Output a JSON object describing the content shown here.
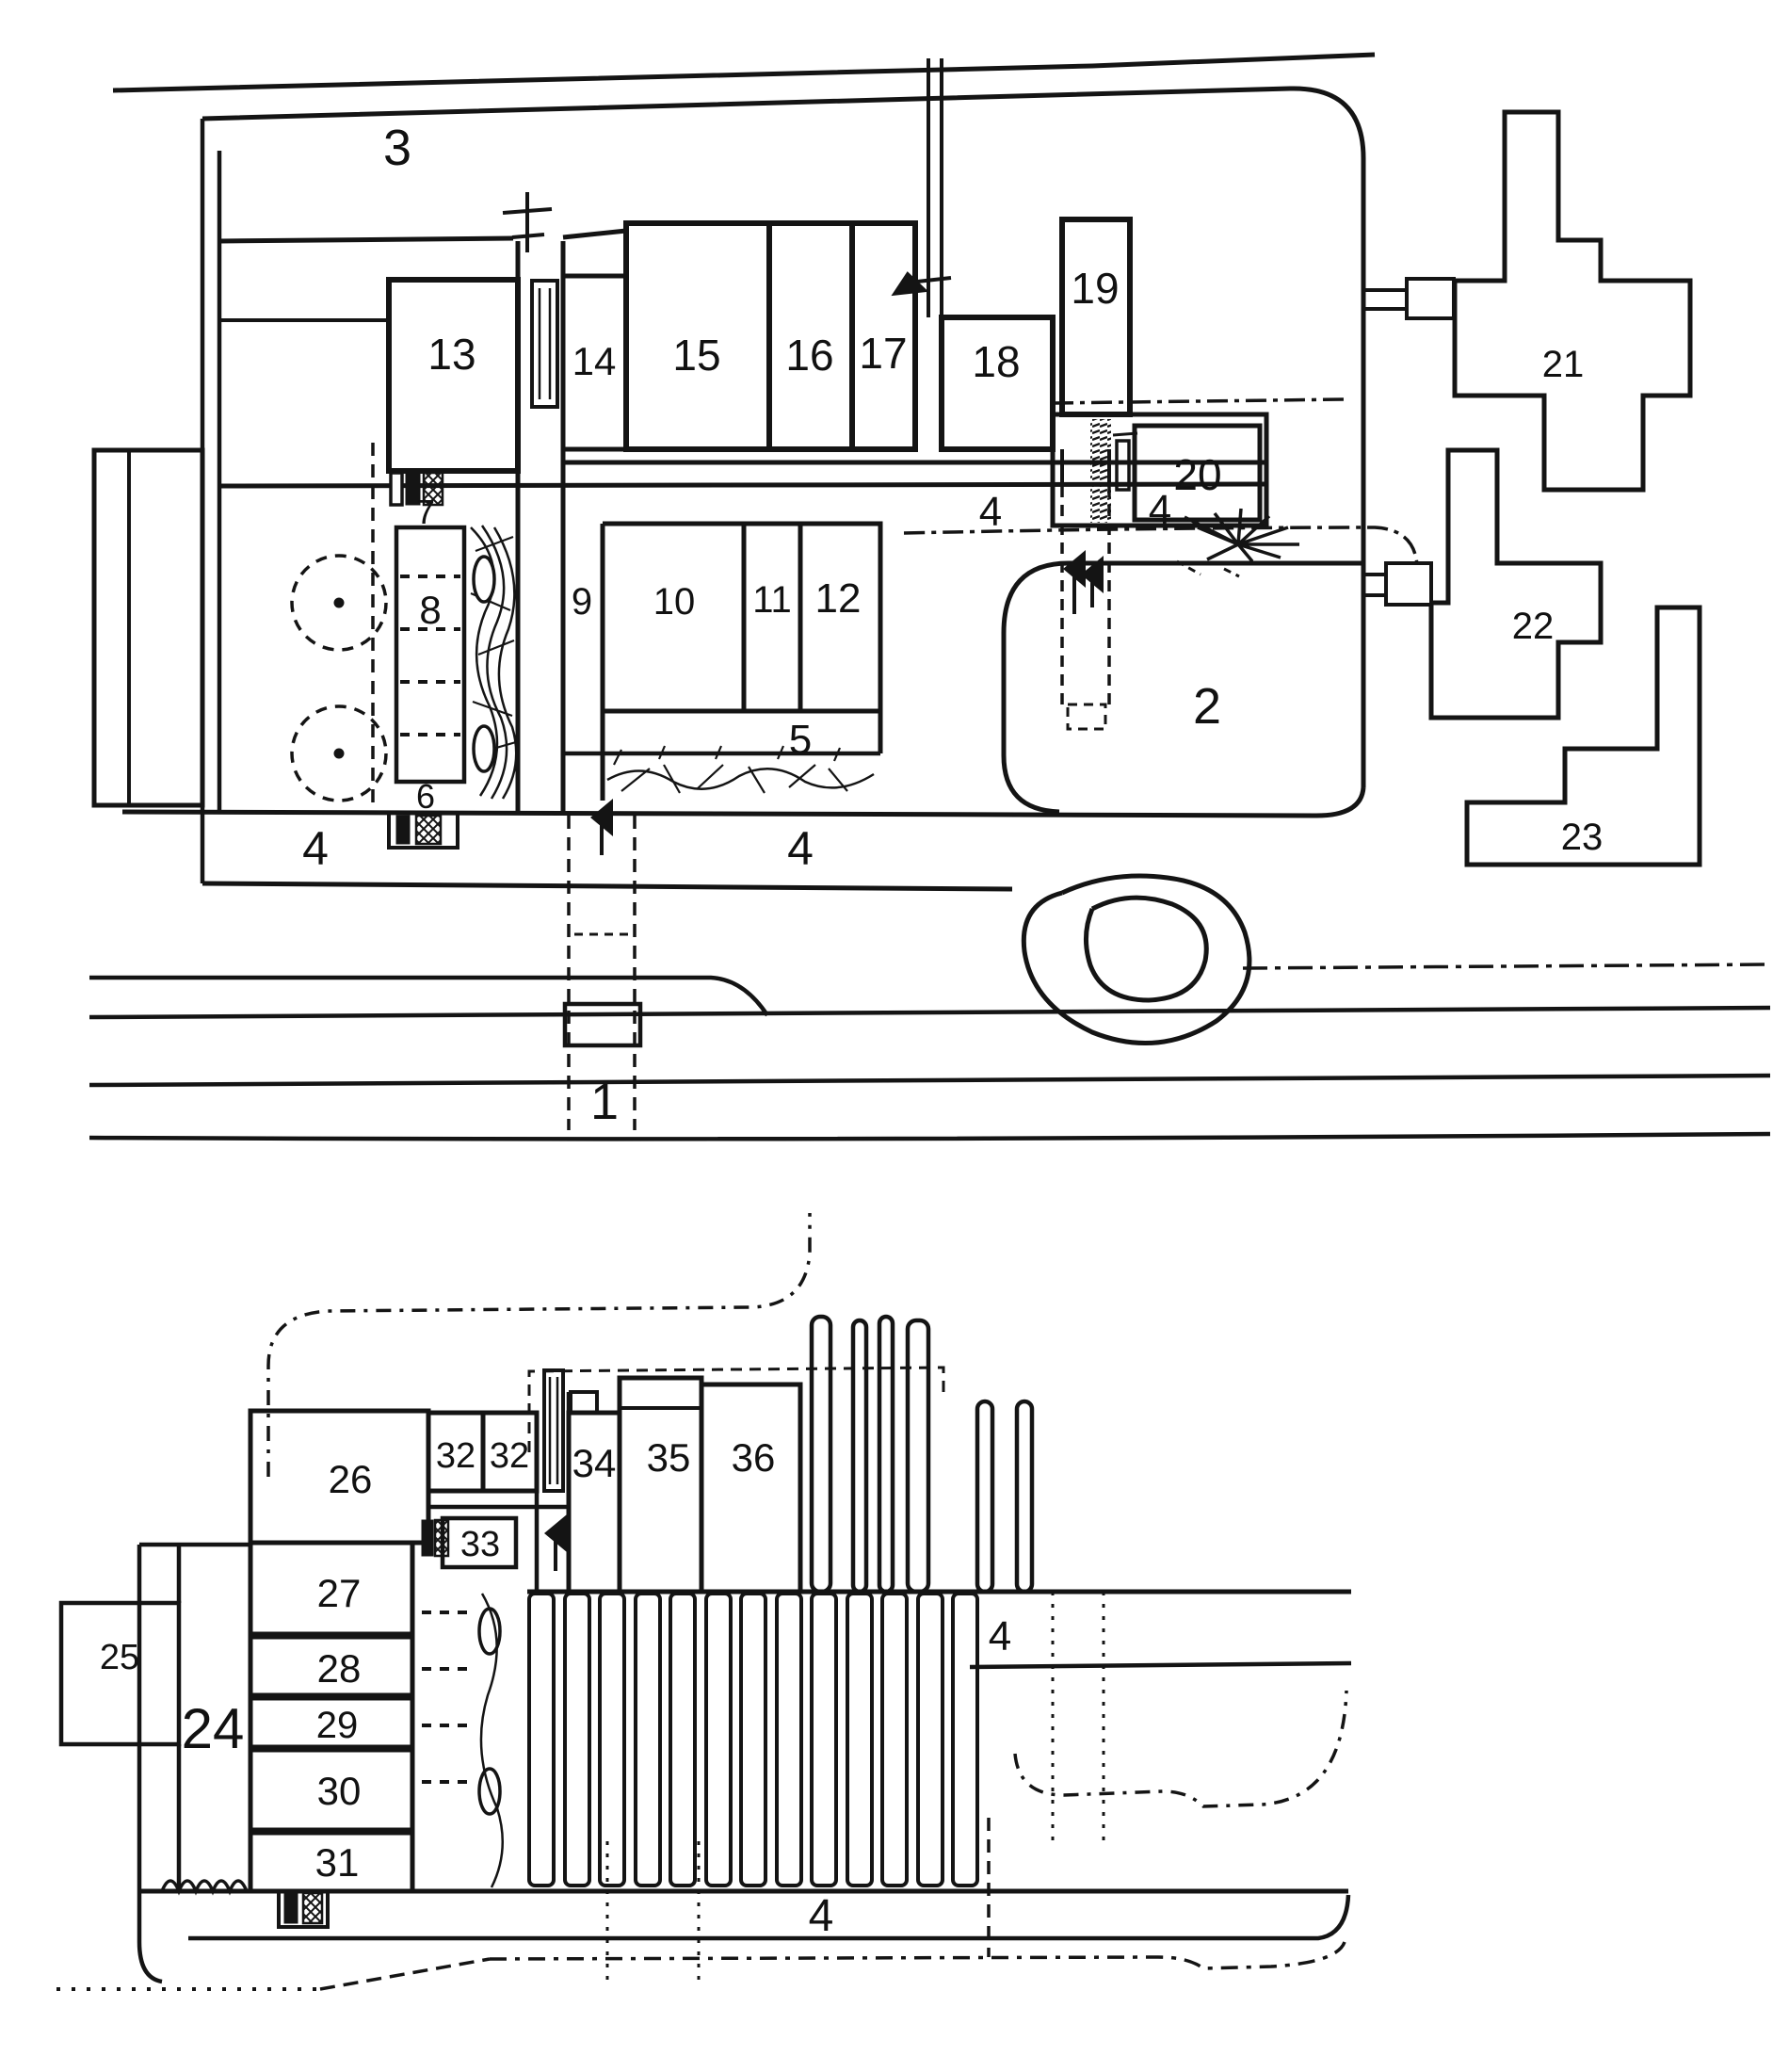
{
  "figure": {
    "kind": "scanned hand-drawn site plan (patent style)",
    "ink_color": "#141414",
    "background_color": "#ffffff",
    "plans": [
      "upper site plan",
      "lower site plan"
    ]
  },
  "upper_plan": {
    "labels": [
      "3",
      "13",
      "14",
      "15",
      "16",
      "17",
      "18",
      "19",
      "20",
      "21",
      "22",
      "23",
      "2",
      "4",
      "4",
      "7",
      "8",
      "9",
      "10",
      "11",
      "12",
      "5",
      "6",
      "4",
      "4",
      "1"
    ]
  },
  "lower_plan": {
    "labels": [
      "26",
      "27",
      "28",
      "29",
      "30",
      "31",
      "32",
      "32",
      "33",
      "34",
      "35",
      "36",
      "24",
      "25",
      "4",
      "4"
    ]
  }
}
